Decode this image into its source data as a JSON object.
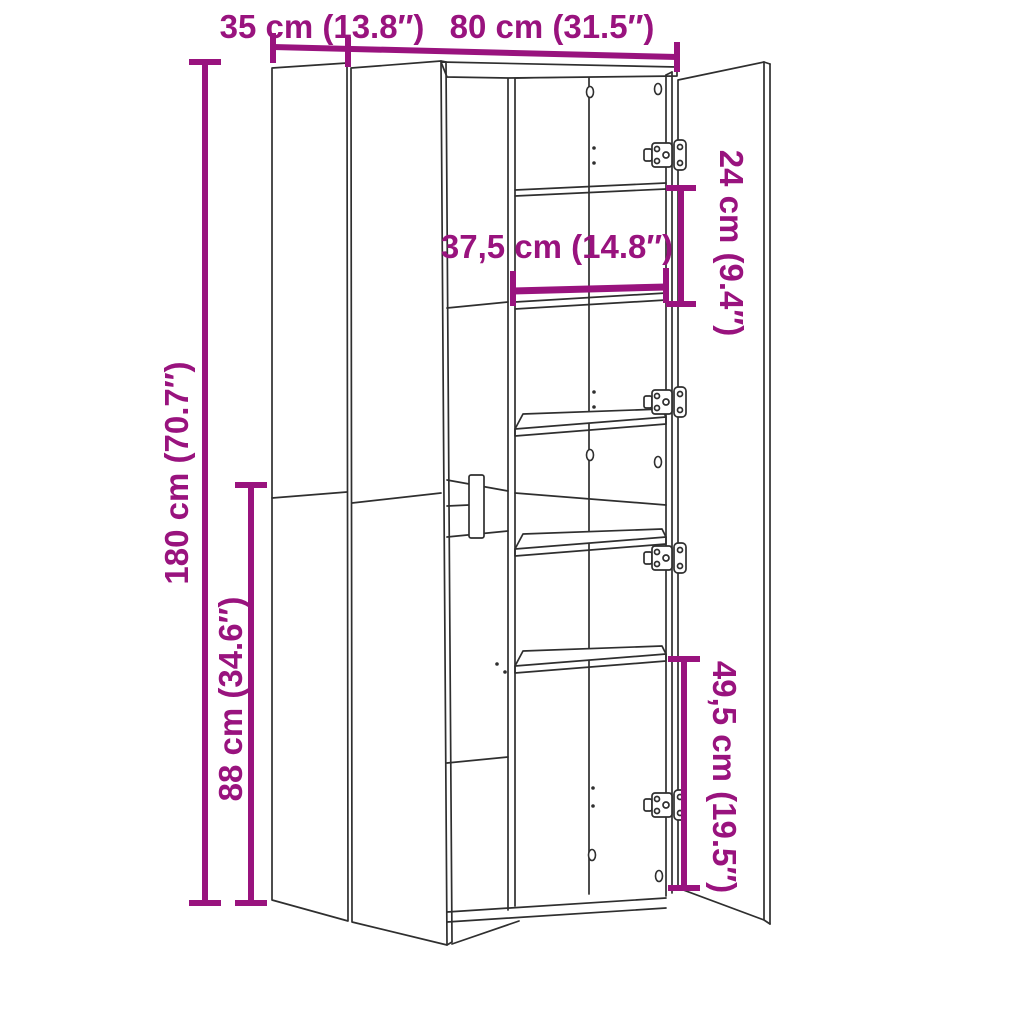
{
  "page": {
    "background": "#FFFFFF"
  },
  "diagram": {
    "title": "Cabinet dimension diagram",
    "subject": "two-door highboard cabinet, right door open showing shelves",
    "labels": {
      "depth": "35 cm (13.8″)",
      "width": "80 cm (31.5″)",
      "height": "180 cm (70.7″)",
      "lower_section": "88 cm (34.6″)",
      "top_compartment": "24 cm (9.4″)",
      "inner_width": "37,5 cm (14.8″)",
      "bottom_compartment": "49,5 cm (19.5″)"
    },
    "colors": {
      "dimension": "#99137E",
      "outline": "#2F2F2F",
      "background": "#FFFFFF"
    }
  }
}
